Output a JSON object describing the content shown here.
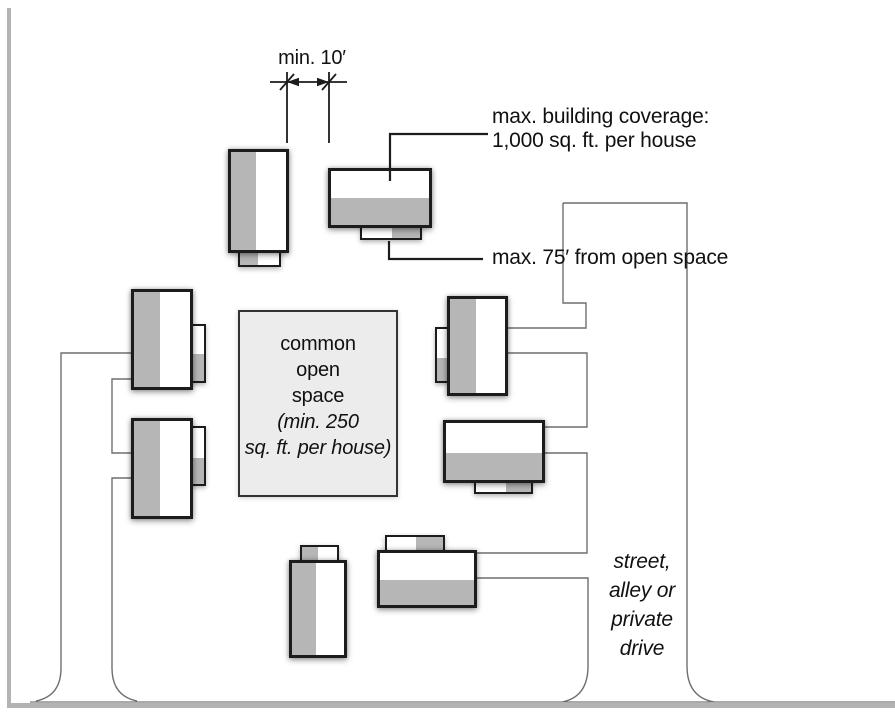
{
  "palette": {
    "background": "#ffffff",
    "house_border": "#1c1c1c",
    "house_fill": "#ffffff",
    "house_gray": "#b6b6b6",
    "open_space_fill": "#ececec",
    "open_space_border": "#333333",
    "drive_line": "#6f6f6f",
    "leader_line": "#1c1c1c",
    "street_edge": "#b3b3b3",
    "curb_line": "#555555",
    "text_color": "#111111"
  },
  "annotations": {
    "min_gap": "min. 10′",
    "coverage": [
      "max. building coverage:",
      "1,000 sq. ft. per house"
    ],
    "setback": "max. 75′ from open space",
    "open_space_title": [
      "common",
      "open",
      "space"
    ],
    "open_space_note": [
      "(min. 250",
      "sq. ft. per house)"
    ],
    "street": [
      "street,",
      "alley or",
      "private",
      "drive"
    ]
  },
  "labels": [
    {
      "name": "min-gap-label",
      "x": 312,
      "y": 46,
      "align": "center",
      "italic": false,
      "size": 20,
      "lh": 24,
      "lines": [
        "min. 10′"
      ]
    },
    {
      "name": "coverage-label",
      "x": 492,
      "y": 105,
      "align": "left",
      "italic": false,
      "size": 21,
      "lh": 24,
      "lines": [
        "max. building coverage:",
        "1,000 sq. ft. per house"
      ]
    },
    {
      "name": "setback-label",
      "x": 492,
      "y": 246,
      "align": "left",
      "italic": false,
      "size": 21,
      "lh": 24,
      "lines": [
        "max. 75′ from open space"
      ]
    },
    {
      "name": "open-space-label",
      "x": 318,
      "y": 331,
      "align": "center",
      "italic": false,
      "size": 20,
      "lh": 26,
      "lines": [
        "common",
        "open",
        "space"
      ]
    },
    {
      "name": "open-space-note",
      "x": 318,
      "y": 409,
      "align": "center",
      "italic": true,
      "size": 20,
      "lh": 26,
      "lines": [
        "(min. 250",
        "sq. ft. per house)"
      ]
    },
    {
      "name": "street-label",
      "x": 642,
      "y": 547,
      "align": "center",
      "italic": true,
      "size": 21,
      "lh": 29,
      "lines": [
        "street,",
        "alley or",
        "private",
        "drive"
      ]
    }
  ],
  "diagram": {
    "open_space_box": {
      "name": "common-open-space",
      "x": 238,
      "y": 310,
      "w": 160,
      "h": 187
    },
    "houses": [
      {
        "name": "house-top-left",
        "x": 228,
        "y": 149,
        "w": 61,
        "h": 104,
        "gray": {
          "side": "left",
          "frac": 0.46
        },
        "stub": {
          "x": 238,
          "y": 250,
          "w": 43,
          "h": 17,
          "gray": {
            "side": "left",
            "frac": 0.47
          }
        }
      },
      {
        "name": "house-top-middle",
        "x": 328,
        "y": 168,
        "w": 104,
        "h": 60,
        "gray": {
          "side": "bottom",
          "frac": 0.5
        },
        "stub": {
          "x": 360,
          "y": 225,
          "w": 62,
          "h": 15,
          "gray": {
            "side": "right",
            "frac": 0.48
          }
        }
      },
      {
        "name": "house-right-top",
        "x": 447,
        "y": 296,
        "w": 61,
        "h": 100,
        "gray": {
          "side": "left",
          "frac": 0.48
        },
        "stub": {
          "x": 435,
          "y": 327,
          "w": 14,
          "h": 56,
          "gray": {
            "side": "bottom",
            "frac": 0.45
          }
        }
      },
      {
        "name": "house-right-middle",
        "x": 443,
        "y": 420,
        "w": 102,
        "h": 63,
        "gray": {
          "side": "bottom",
          "frac": 0.47
        },
        "stub": {
          "x": 474,
          "y": 480,
          "w": 59,
          "h": 14,
          "gray": {
            "side": "right",
            "frac": 0.45
          }
        }
      },
      {
        "name": "house-bottom-middle",
        "x": 377,
        "y": 550,
        "w": 100,
        "h": 58,
        "gray": {
          "side": "bottom",
          "frac": 0.48
        },
        "stub": {
          "x": 385,
          "y": 535,
          "w": 60,
          "h": 17,
          "gray": {
            "side": "right",
            "frac": 0.48
          }
        }
      },
      {
        "name": "house-bottom-left",
        "x": 289,
        "y": 560,
        "w": 58,
        "h": 98,
        "gray": {
          "side": "left",
          "frac": 0.47
        },
        "stub": {
          "x": 300,
          "y": 545,
          "w": 39,
          "h": 17,
          "gray": {
            "side": "left",
            "frac": 0.45
          }
        }
      },
      {
        "name": "house-left-top",
        "x": 131,
        "y": 289,
        "w": 62,
        "h": 101,
        "gray": {
          "side": "left",
          "frac": 0.47
        },
        "stub": {
          "x": 191,
          "y": 324,
          "w": 15,
          "h": 59,
          "gray": {
            "side": "bottom",
            "frac": 0.5
          }
        }
      },
      {
        "name": "house-left-bottom",
        "x": 131,
        "y": 418,
        "w": 62,
        "h": 101,
        "gray": {
          "side": "left",
          "frac": 0.47
        },
        "stub": {
          "x": 191,
          "y": 426,
          "w": 15,
          "h": 60,
          "gray": {
            "side": "bottom",
            "frac": 0.47
          }
        }
      }
    ],
    "street_bars": [
      {
        "name": "street-edge-left",
        "x": 7,
        "y": 8,
        "w": 4,
        "h": 700
      },
      {
        "name": "street-edge-bottom",
        "x": 7,
        "y": 703,
        "w": 888,
        "h": 5
      }
    ],
    "curb": {
      "name": "street-curb-line",
      "d": "M30,702 H895",
      "w": 1
    },
    "paths_under": [
      {
        "name": "shared-drive-left-edge",
        "d": "M131,353 H61 V668 Q61,696 36,701",
        "w": 1.4
      },
      {
        "name": "shared-drive-inner-edge-upper",
        "d": "M131,379 H112 V453 H131",
        "w": 1.4
      },
      {
        "name": "shared-drive-inner-edge-lower",
        "d": "M131,478 H112 V668 Q112,696 137,701",
        "w": 1.4
      },
      {
        "name": "street-outline-right",
        "d": "M563,203 H687 V666 Q687,697 714,702",
        "w": 1.4
      },
      {
        "name": "street-outline-left-upper",
        "d": "M563,203 V303 H586 V328 H508",
        "w": 1.4
      },
      {
        "name": "driveway-house-right-top",
        "d": "M508,353 H587 V427 H545",
        "w": 1.4
      },
      {
        "name": "driveway-house-right-middle",
        "d": "M545,453 H587 V553 H477",
        "w": 1.4
      },
      {
        "name": "driveway-house-bottom",
        "d": "M477,578 H588 V666 Q588,697 562,702",
        "w": 1.4
      }
    ],
    "paths_over": [
      {
        "name": "coverage-leader",
        "d": "M488,134 H390 V181",
        "w": 2.2
      },
      {
        "name": "setback-leader",
        "d": "M389,241 V259 H483",
        "w": 2.2
      },
      {
        "name": "dimension-line",
        "d": "M270,82 H347",
        "w": 1.8
      },
      {
        "name": "extension-line-left",
        "d": "M287,72 V143",
        "w": 1.8
      },
      {
        "name": "extension-line-right",
        "d": "M329,72 V143",
        "w": 1.8
      },
      {
        "name": "dimension-tick-left",
        "d": "M280,90 L294,74",
        "w": 1.8
      },
      {
        "name": "dimension-tick-right",
        "d": "M322,90 L336,74",
        "w": 1.8
      }
    ],
    "arrowheads": [
      {
        "name": "dimension-arrow-left",
        "d": "M287,82 L299,77.7 L299,86.3 Z"
      },
      {
        "name": "dimension-arrow-right",
        "d": "M329,82 L317,77.7 L317,86.3 Z"
      }
    ]
  }
}
